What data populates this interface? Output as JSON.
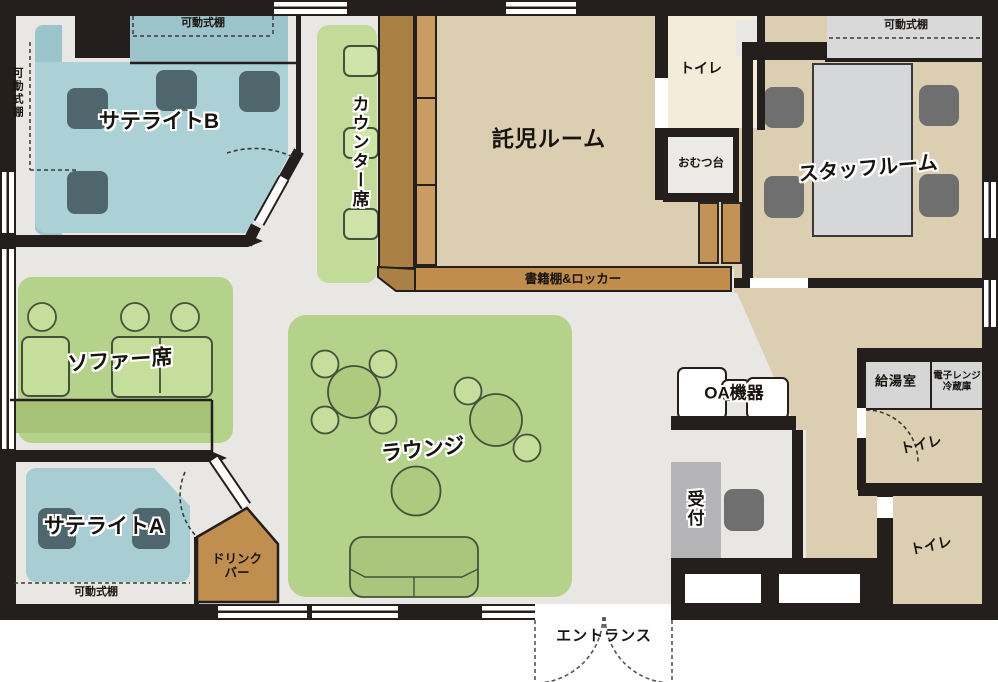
{
  "title": "施設フロアマップ",
  "rooms": {
    "satellite_b": {
      "label": "サテライトB"
    },
    "satellite_a": {
      "label": "サテライトA"
    },
    "counter_seats": {
      "label": "カウンター席"
    },
    "childcare_room": {
      "label": "託児ルーム"
    },
    "staff_room": {
      "label": "スタッフルーム"
    },
    "sofa_seats": {
      "label": "ソファー席"
    },
    "lounge": {
      "label": "ラウンジ"
    },
    "reception": {
      "label": "受付"
    },
    "oa_equipment": {
      "label": "OA機器"
    },
    "kitchenette": {
      "label": "給湯室"
    },
    "microwave_fridge": {
      "line1": "電子レンジ",
      "line2": "冷蔵庫"
    },
    "drink_bar": {
      "line1": "ドリンク",
      "line2": "バー"
    },
    "toilet": {
      "label": "トイレ"
    },
    "diaper_station": {
      "label": "おむつ台"
    },
    "bookshelf_locker": {
      "label": "書籍棚&ロッカー"
    },
    "movable_shelf": {
      "label": "可動式棚"
    },
    "entrance": {
      "label": "エントランス"
    }
  },
  "colors": {
    "wall": "#241f1c",
    "floor": "#e9e7e3",
    "corridor_beige": "#dccfb1",
    "carpet_teal": "#abd0d5",
    "carpet_teal_dark": "#9cc5cb",
    "green_area": "#b5d28b",
    "green_seat": "#cfe4a8",
    "sofa_green": "#a5c277",
    "counter_brown_dark": "#aa8045",
    "counter_brown_light": "#c99d61",
    "bookshelf_brown": "#c08d4d",
    "drinkbar_brown": "#c08e4e",
    "desk_slate": "#50666d",
    "chair_gray": "#6f6f6f",
    "toilet_cream": "#f3ecda",
    "box_gray": "#d6d6d6"
  }
}
